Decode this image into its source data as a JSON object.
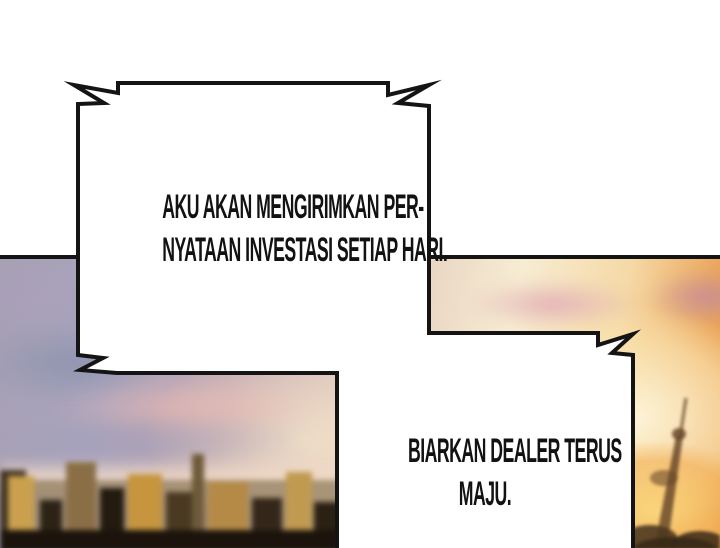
{
  "panel": {
    "bubble1": {
      "line1": "AKU AKAN MENGIRIMKAN PER-",
      "line2": "NYATAAN INVESTASI SETIAP HARI."
    },
    "bubble2": {
      "line1": "BIARKAN DEALER TERUS",
      "line2": "MAJU."
    }
  },
  "background": {
    "type": "photo",
    "subject": "blurred-city-skyline-at-sunset"
  },
  "colors": {
    "page": "#ffffff",
    "bubble_fill": "#ffffff",
    "bubble_border": "#141414",
    "photo_border": "#141414",
    "text": "#121212",
    "sky_lavender": "#a8a0b4",
    "sky_pink": "#e3b8b4",
    "sunset_cream": "#f7ecd2",
    "sunset_orange": "#e69448",
    "city_gold": "#c6953e",
    "city_dark": "#231a10"
  }
}
